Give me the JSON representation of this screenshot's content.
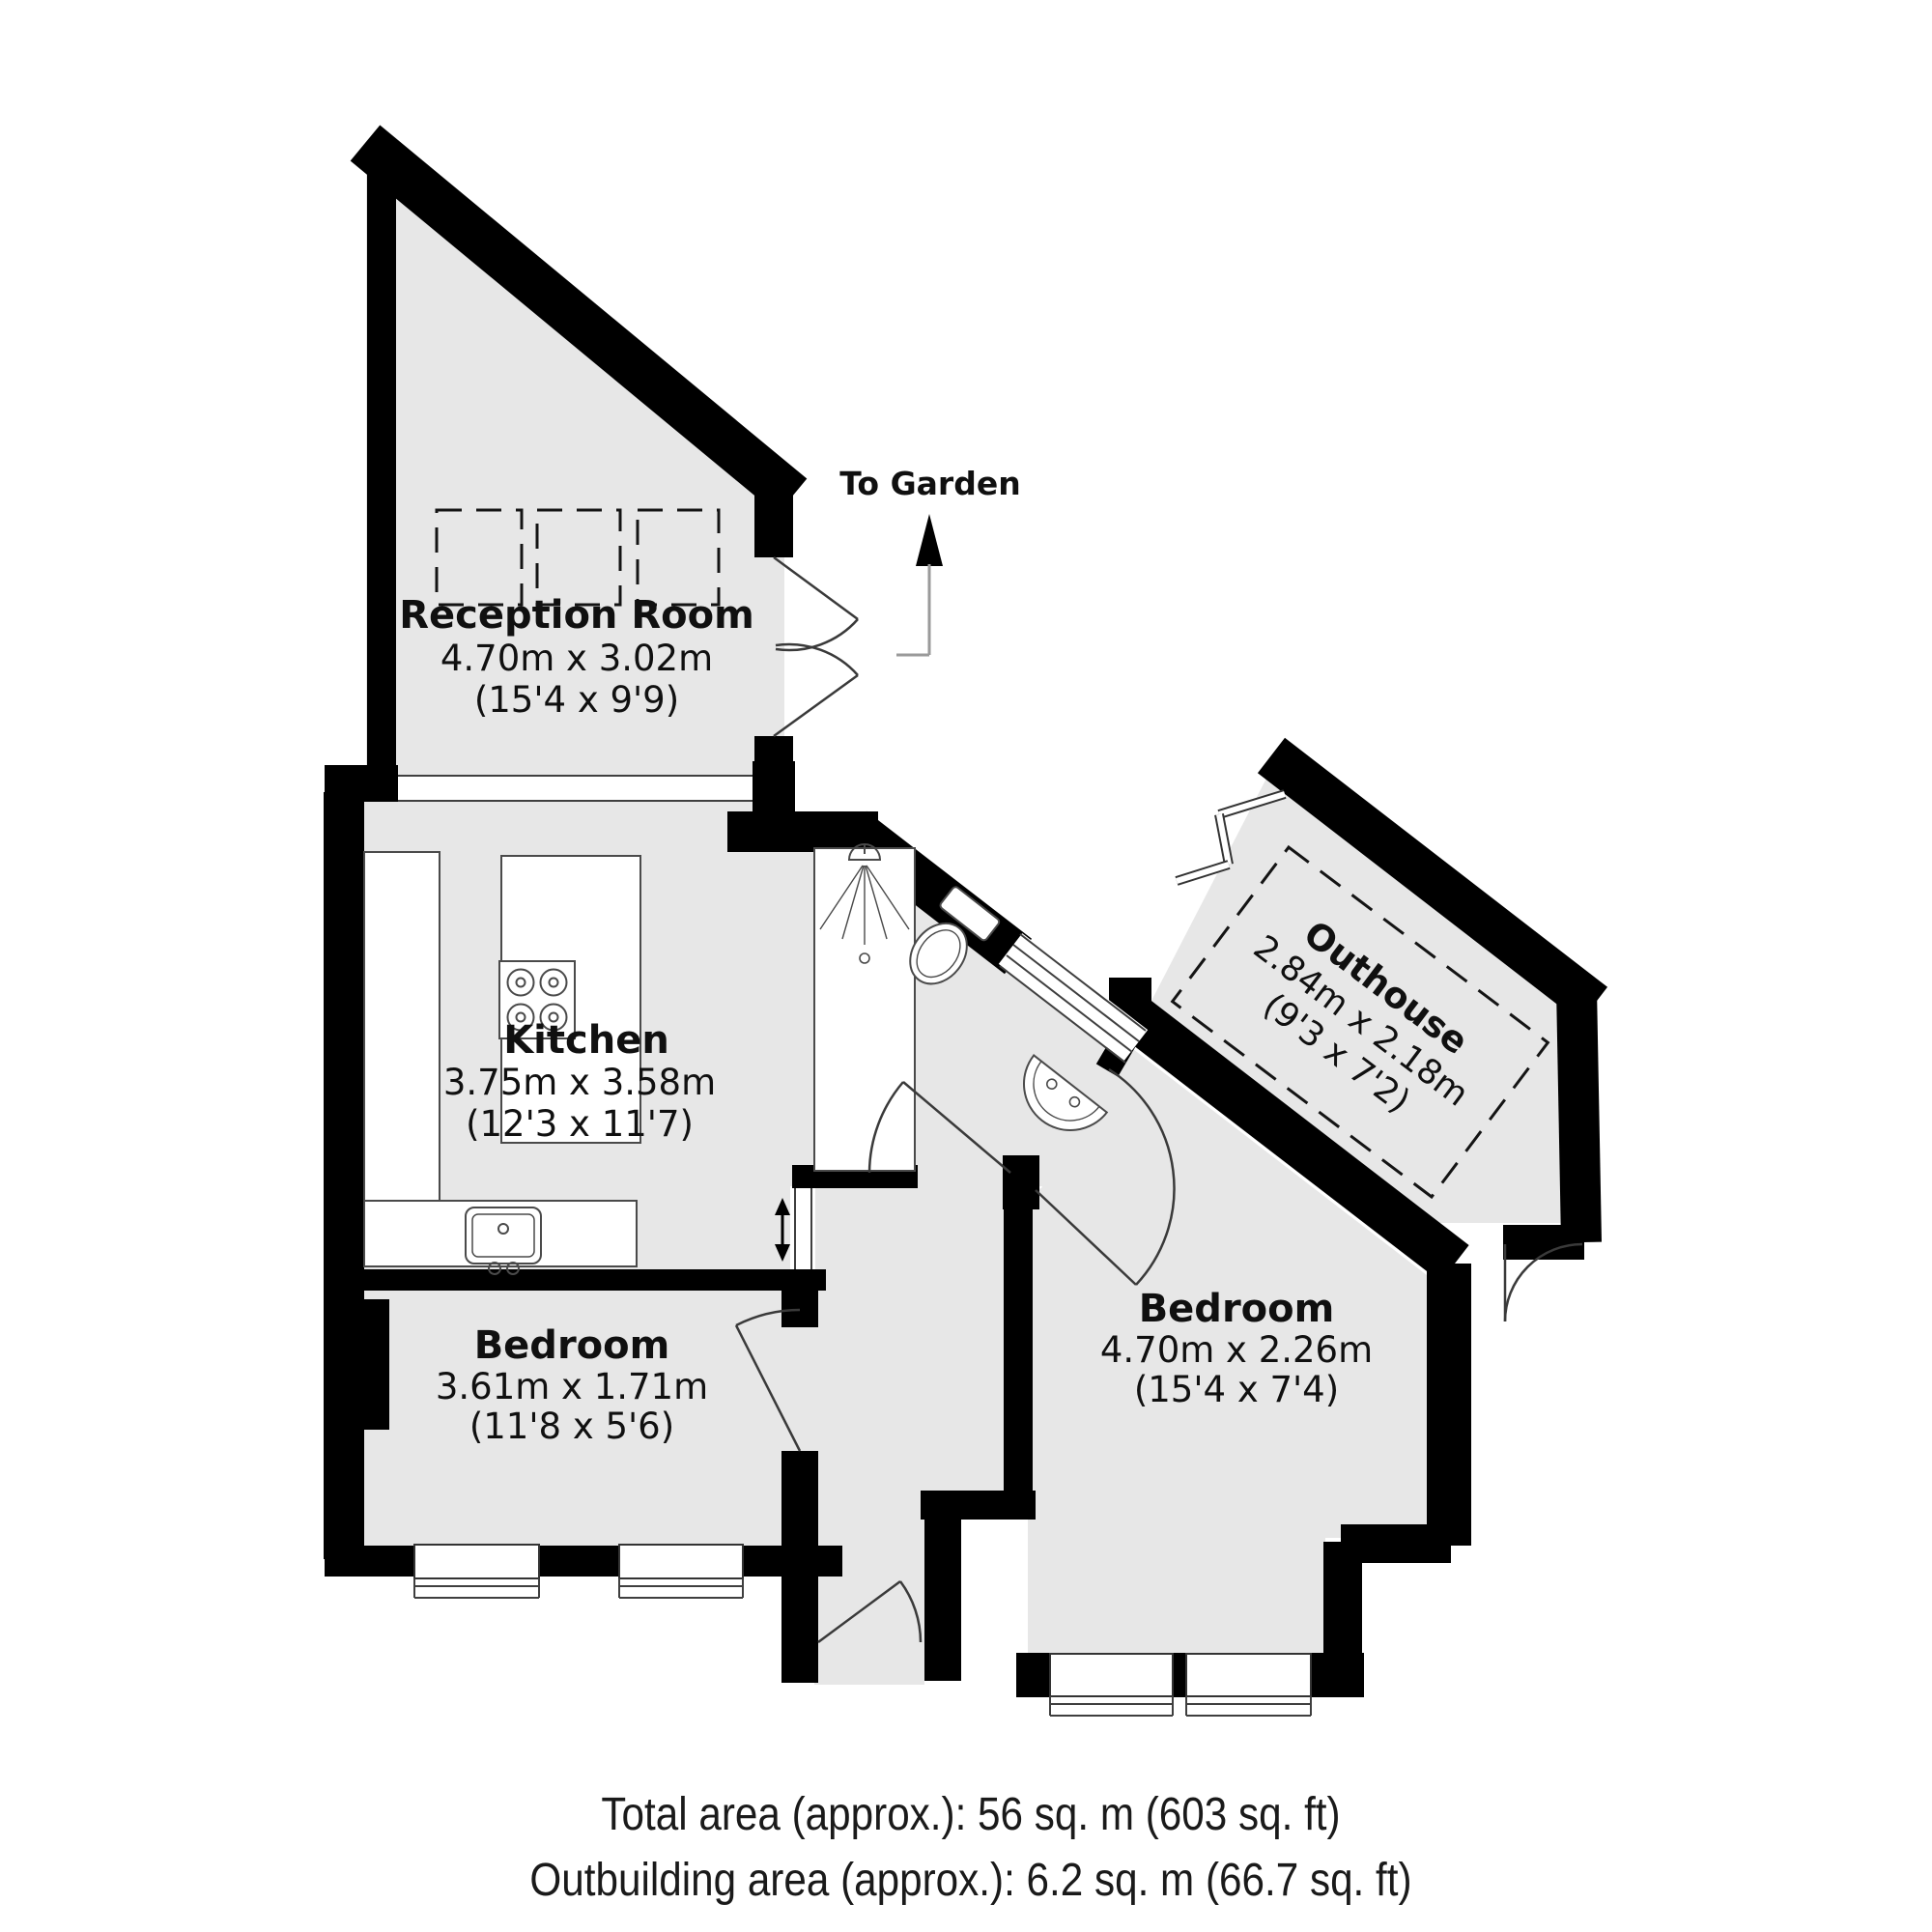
{
  "plan": {
    "to_garden_label": "To Garden",
    "rooms": {
      "reception": {
        "name": "Reception Room",
        "metric": "4.70m x 3.02m",
        "imperial": "(15'4 x 9'9)"
      },
      "kitchen": {
        "name": "Kitchen",
        "metric": "3.75m x 3.58m",
        "imperial": "(12'3 x 11'7)"
      },
      "bedroom_left": {
        "name": "Bedroom",
        "metric": "3.61m x 1.71m",
        "imperial": "(11'8 x 5'6)"
      },
      "bedroom_right": {
        "name": "Bedroom",
        "metric": "4.70m x 2.26m",
        "imperial": "(15'4 x 7'4)"
      },
      "outhouse": {
        "name": "Outhouse",
        "metric": "2.84m x 2.18m",
        "imperial": "(9'3 x 7'2)"
      }
    },
    "footer": {
      "total_area": "Total area (approx.): 56 sq. m (603 sq. ft)",
      "outbuilding_area": "Outbuilding area (approx.): 6.2 sq. m (66.7 sq. ft)"
    },
    "colors": {
      "wall": "#000000",
      "floor": "#e7e7e7",
      "fixture_line": "#4a4a4a"
    }
  }
}
